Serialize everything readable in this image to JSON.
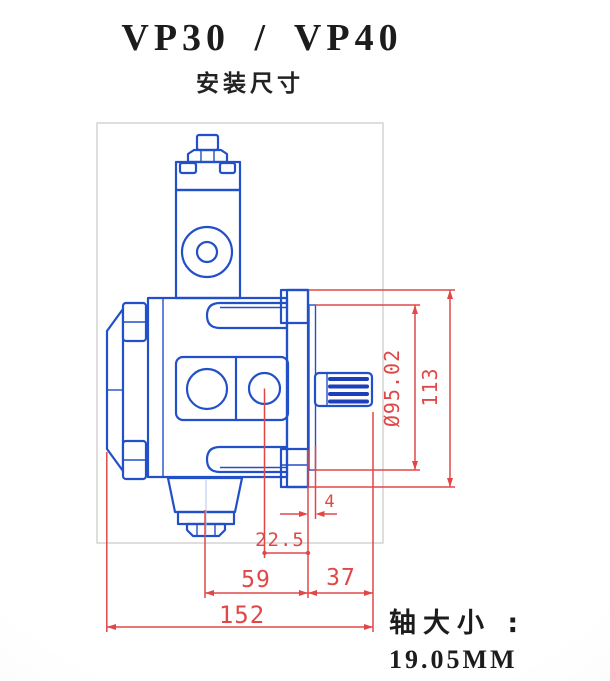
{
  "page": {
    "title": "VP30 / VP40",
    "subtitle": "安装尺寸"
  },
  "note": {
    "label": "轴大小 :",
    "value": "19.05MM"
  },
  "drawing": {
    "dims": {
      "overall_length": "152",
      "body_length": "59",
      "shaft_extension": "37",
      "port_to_flange": "22.5",
      "spigot_depth": "4",
      "pilot_diameter": "Ø95.02",
      "flange_height": "113"
    },
    "colors": {
      "line_blue": "#2150c8",
      "line_dark_blue": "#1d3fb7",
      "dimension_red": "#e04848",
      "frame_gray": "#cccccc",
      "text_dark": "#1c1c1c"
    }
  }
}
